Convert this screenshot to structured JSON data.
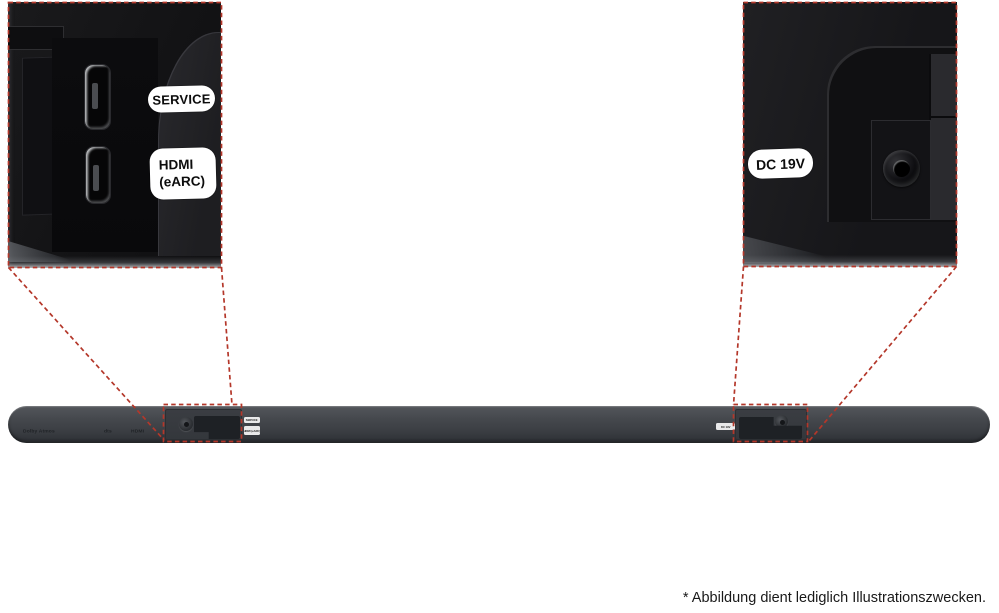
{
  "colors": {
    "accent_red": "#b4372a",
    "pill_bg": "#ffffff",
    "pill_text": "#0c0c0c",
    "page_bg": "#ffffff"
  },
  "callout_left": {
    "service_label": "SERVICE",
    "hdmi_label_line1": "HDMI",
    "hdmi_label_line2": "(eARC)"
  },
  "callout_right": {
    "dc_label": "DC 19V"
  },
  "soundbar": {
    "logos": {
      "dolby": "Dolby Atmos",
      "dts": "dts",
      "hdmi": "HDMI"
    },
    "mini_label_service": "SERVICE",
    "mini_label_hdmi": "HDMI (eARC)",
    "mini_label_dc": "DC 19V"
  },
  "footer": {
    "disclaimer": "* Abbildung dient lediglich Illustrationszwecken."
  }
}
